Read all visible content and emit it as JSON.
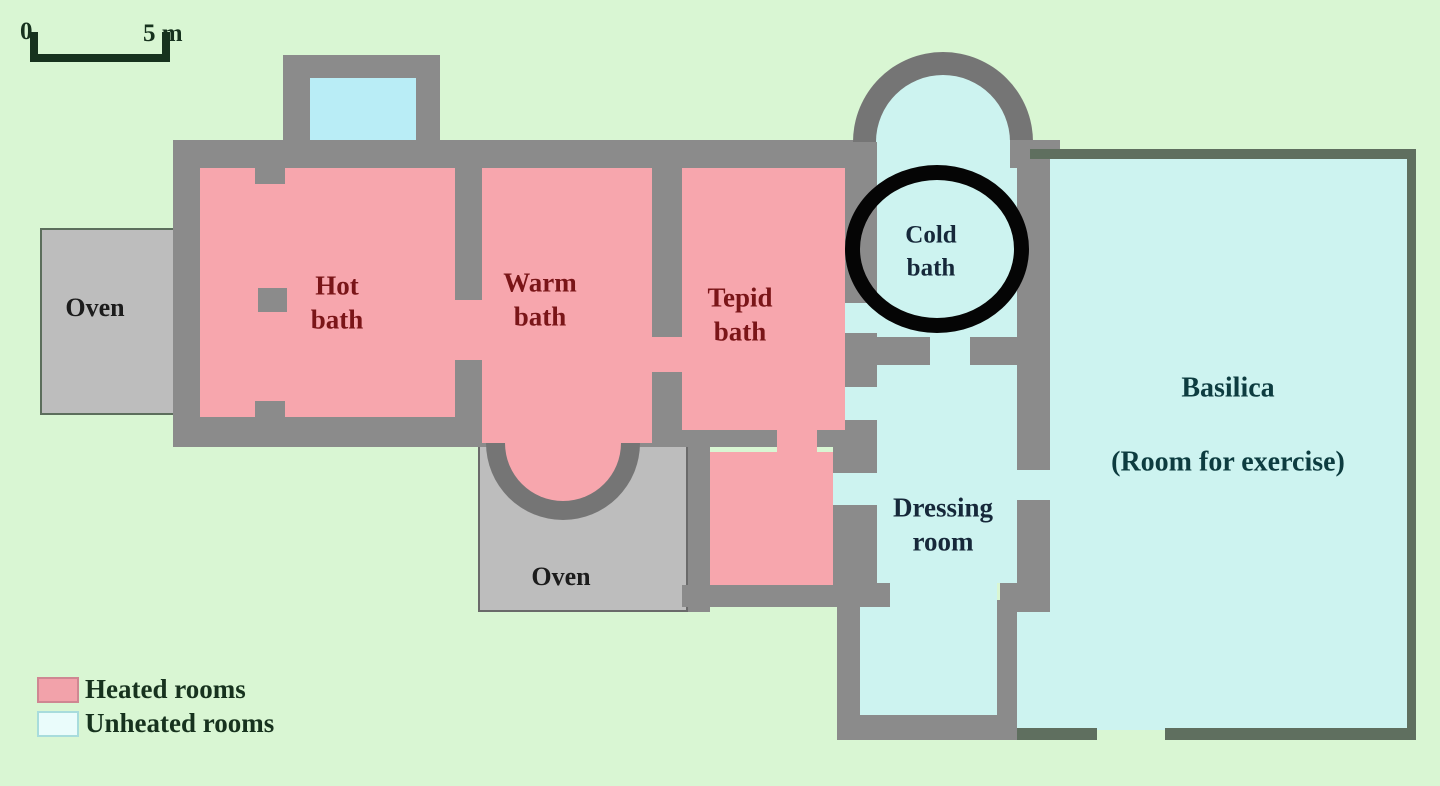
{
  "scale": {
    "zero": "0",
    "five_m": "5 m"
  },
  "rooms": {
    "oven_left": {
      "label": "Oven",
      "type": "oven"
    },
    "hot_bath": {
      "line1": "Hot",
      "line2": "bath",
      "type": "heated"
    },
    "warm_bath": {
      "line1": "Warm",
      "line2": "bath",
      "type": "heated"
    },
    "tepid_bath": {
      "line1": "Tepid",
      "line2": "bath",
      "type": "heated"
    },
    "cold_bath": {
      "line1": "Cold",
      "line2": "bath",
      "type": "unheated",
      "highlighted": true
    },
    "oven_bottom": {
      "label": "Oven",
      "type": "oven"
    },
    "dressing_room": {
      "line1": "Dressing",
      "line2": "room",
      "type": "unheated"
    },
    "basilica": {
      "name": "Basilica",
      "subtitle": "(Room for exercise)",
      "type": "unheated"
    }
  },
  "legend": {
    "heated": {
      "label": "Heated rooms",
      "color": "#f2a2aa"
    },
    "unheated": {
      "label": "Unheated rooms",
      "color": "#cdf3f0"
    }
  },
  "colors": {
    "background": "#d9f6d3",
    "heated_room": "#f7a6ad",
    "unheated_room": "#cdf3f0",
    "plunge_pool": "#b9edf6",
    "wall": "#8b8b8b",
    "oven_block": "#bdbdbd",
    "highlight_ring": "#050505"
  },
  "annotation": {
    "highlighted_room": "Cold bath"
  }
}
